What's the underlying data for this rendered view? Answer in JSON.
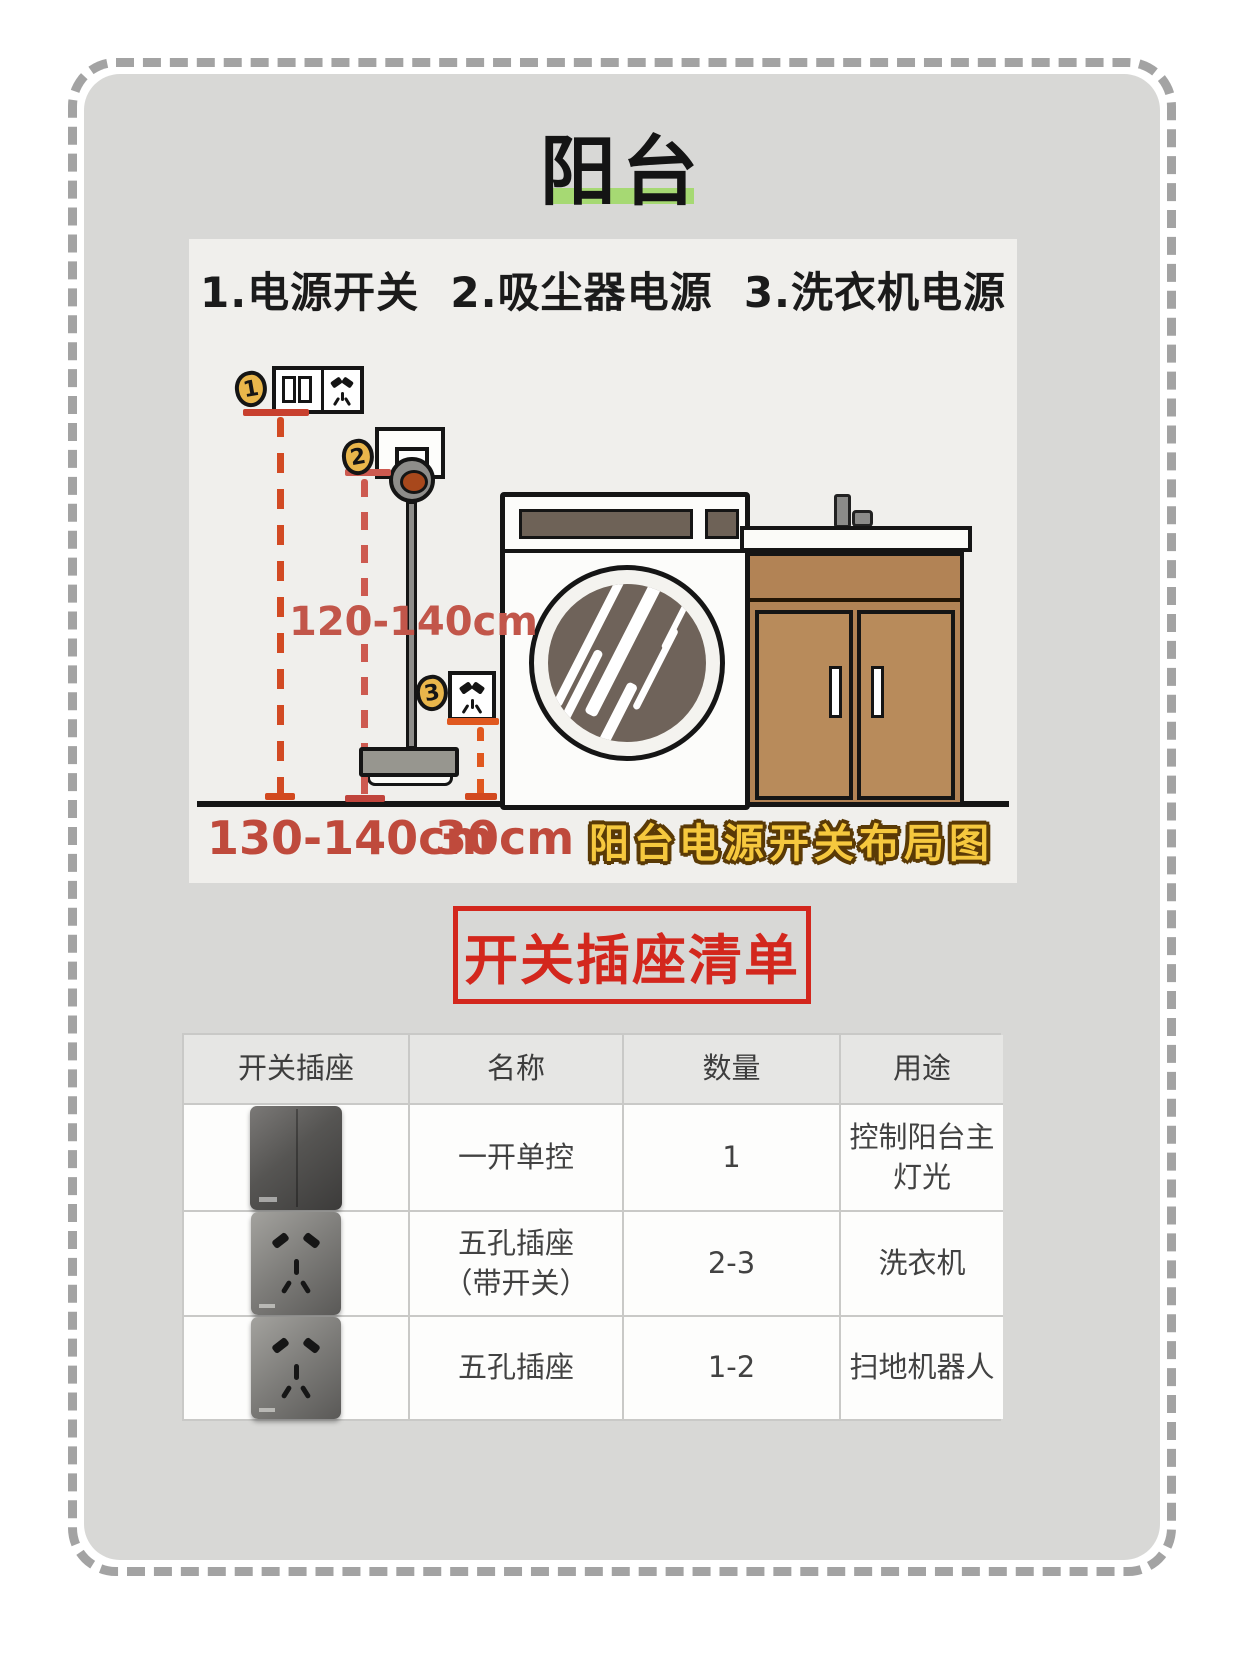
{
  "page": {
    "title": "阳台",
    "section_title": "开关插座清单"
  },
  "diagram": {
    "legend": "1.电源开关  2.吸尘器电源  3.洗衣机电源",
    "badge1": "1",
    "badge2": "2",
    "badge3": "3",
    "measure_vacuum_outlet_height": "120-140cm",
    "measure_switch_height": "130-140cm",
    "measure_floor_socket_height": "30cm",
    "caption": "阳台电源开关布局图"
  },
  "colors": {
    "accent_red": "#d3271d",
    "measure_red": "#bf4a3c",
    "badge_yellow": "#e9b64b",
    "caption_yellow": "#f6c83e",
    "highlight_green": "#a6d973"
  },
  "table": {
    "headers": [
      "开关插座",
      "名称",
      "数量",
      "用途"
    ],
    "rows": [
      {
        "product": "one-gang-switch",
        "name": "一开单控",
        "name2": "",
        "qty": "1",
        "use": "控制阳台主灯光"
      },
      {
        "product": "five-hole-socket-with-switch",
        "name": "五孔插座",
        "name2": "（带开关）",
        "qty": "2-3",
        "use": "洗衣机"
      },
      {
        "product": "five-hole-socket",
        "name": "五孔插座",
        "name2": "",
        "qty": "1-2",
        "use": "扫地机器人"
      }
    ]
  }
}
